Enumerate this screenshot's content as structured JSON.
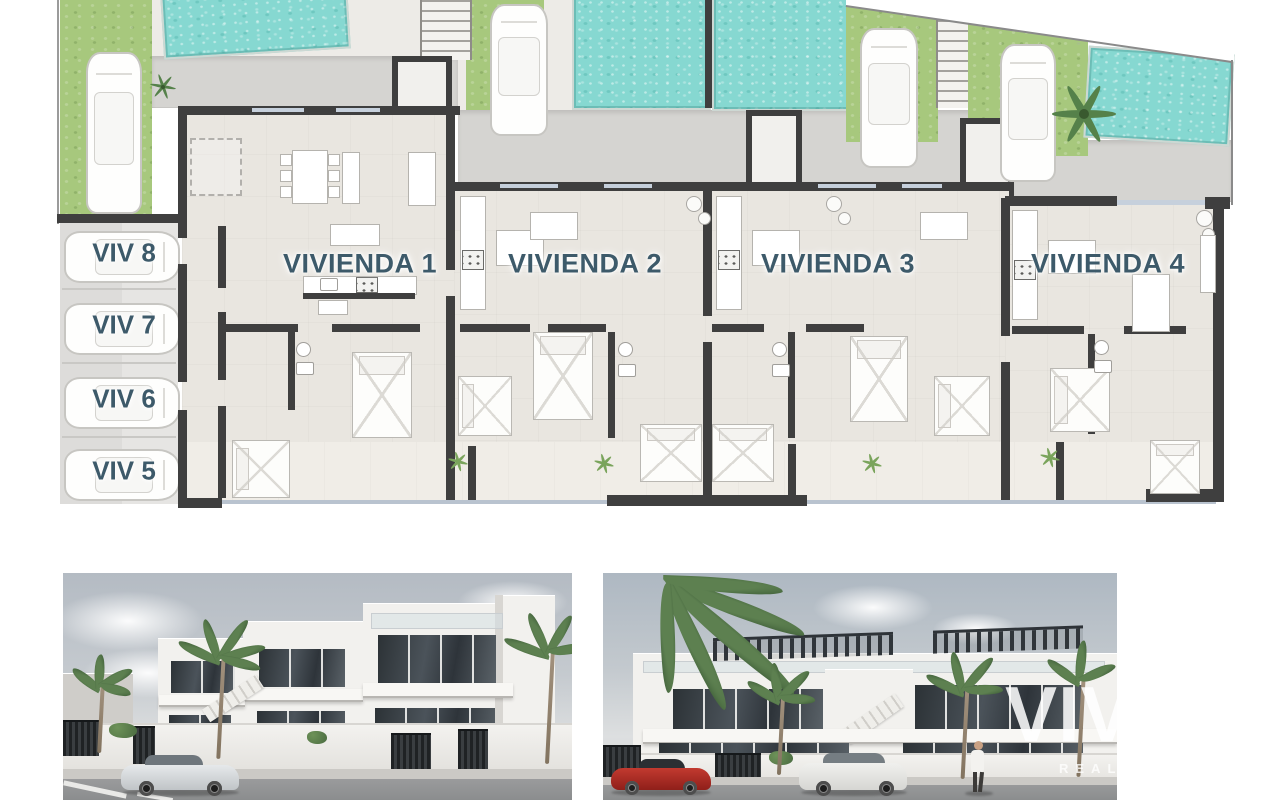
{
  "site_plan": {
    "units": [
      {
        "id": "vivienda-1",
        "label": "VIVIENDA 1"
      },
      {
        "id": "vivienda-2",
        "label": "VIVIENDA 2"
      },
      {
        "id": "vivienda-3",
        "label": "VIVIENDA 3"
      },
      {
        "id": "vivienda-4",
        "label": "VIVIENDA 4"
      }
    ],
    "parking_spaces": [
      {
        "id": "viv-8",
        "label": "VIV 8"
      },
      {
        "id": "viv-7",
        "label": "VIV 7"
      },
      {
        "id": "viv-6",
        "label": "VIV 6"
      },
      {
        "id": "viv-5",
        "label": "VIV 5"
      }
    ],
    "colors": {
      "pool": "#86d8d1",
      "grass": "#a7c87d",
      "driveway": "#d5d4d1",
      "paving": "#edebe7",
      "interior_floor": "#e9e6e0",
      "wall": "#3f3f3f",
      "label_text": "#3d5a6a"
    }
  },
  "watermark": {
    "text": "VIVA",
    "subtext": "REAL"
  },
  "icons": {
    "car_top": "top-view car outline (css shape)",
    "car_side": "side-view car (css shape)",
    "palm": "palm tree (css shape)",
    "person": "pedestrian (css shape)",
    "pool": "water speckle texture (css)",
    "stairs": "tread stripes (css)"
  }
}
